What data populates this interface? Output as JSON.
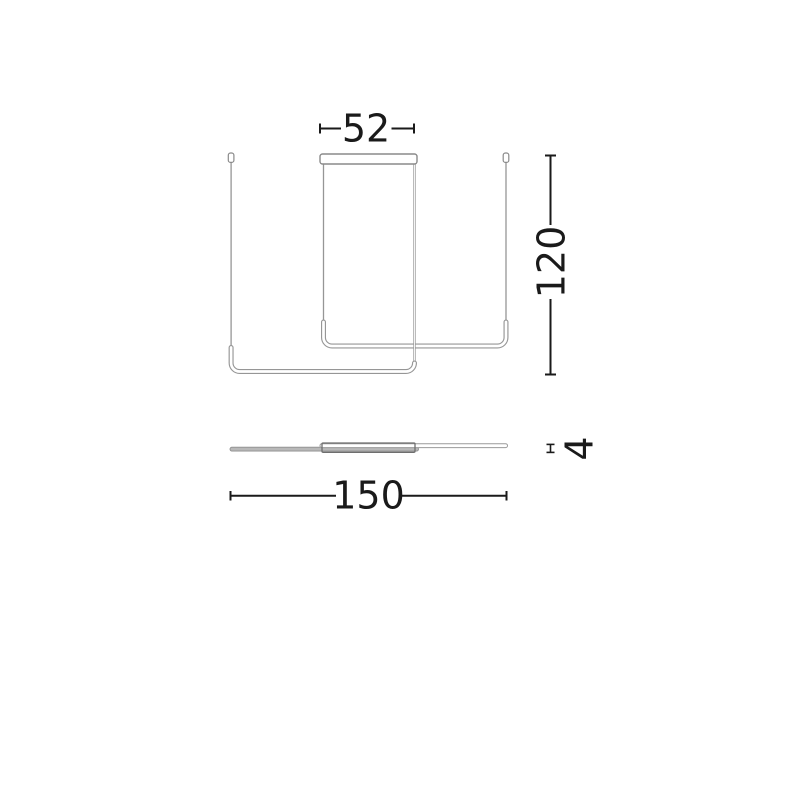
{
  "page": {
    "background_color": "#ffffff",
    "description": "Technical dimension drawing of a linear pendant ceiling lamp: front elevation above, plan (top) view below"
  },
  "colors": {
    "dimension_ink": "#1a1a1a",
    "fixture_line": "#969696",
    "canopy_line": "#8a8a8a",
    "plan_outline": "#6e6e6e",
    "plan_bar_fill": "#b8b8b8",
    "background": "#ffffff"
  },
  "front_view": {
    "dim_canopy_width": {
      "label": "52",
      "orientation": "horizontal"
    },
    "dim_drop_height": {
      "label": "120",
      "orientation": "vertical"
    }
  },
  "plan_view": {
    "dim_total_length": {
      "label": "150",
      "orientation": "horizontal"
    },
    "dim_profile_thickness": {
      "label": "4",
      "orientation": "vertical"
    }
  }
}
